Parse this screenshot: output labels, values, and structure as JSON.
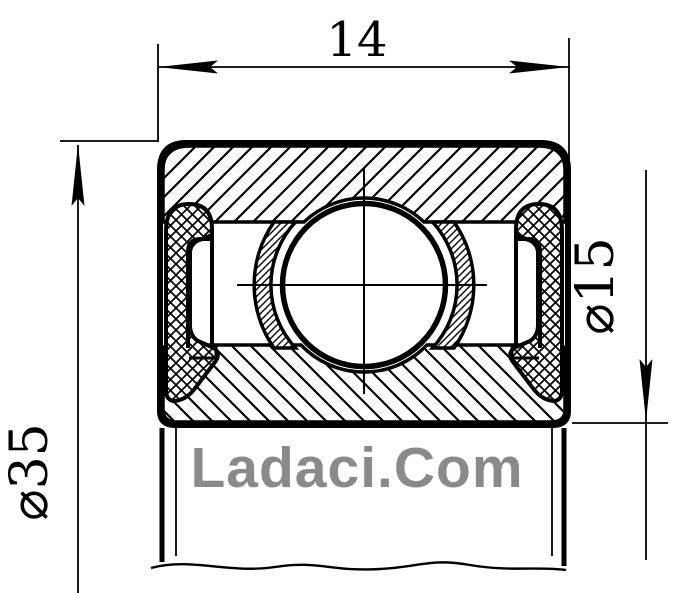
{
  "drawing": {
    "kind": "sealed-ball-bearing-cross-section",
    "dimensions": {
      "width_label": "14",
      "outer_diameter_label": "⌀35",
      "bore_diameter_label": "⌀15"
    },
    "watermark": {
      "text": "Ladaci.Com",
      "color": "#8a8a8a"
    },
    "colors": {
      "line": "#000000",
      "background": "#ffffff"
    }
  }
}
